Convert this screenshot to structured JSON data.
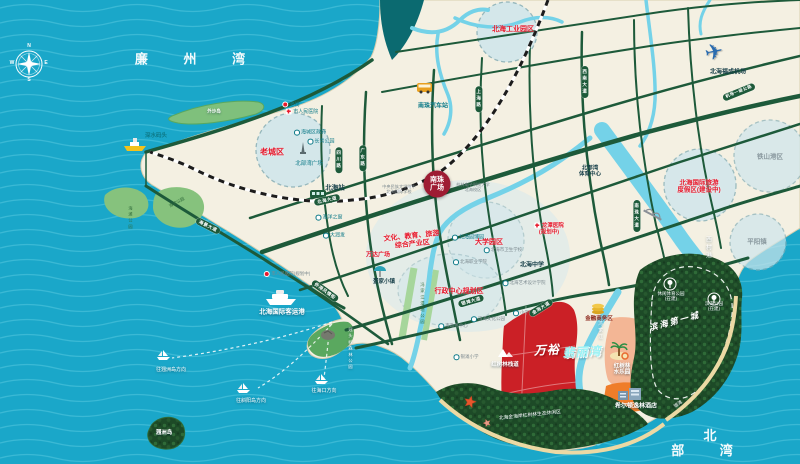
{
  "colors": {
    "ocean": "#1aa7c9",
    "wave": "#55c8de",
    "land": "#f4f0e2",
    "road": "#1d5a3a",
    "river": "#74d2e8",
    "deep_channel": "#0b6a70",
    "forest": "#1d4a27",
    "park": "#86c27d",
    "island": "#7fc07c",
    "zonefill": "#cfe6ec",
    "zonestroke": "#86aeb6",
    "red_zone": "#cb2026",
    "peach": "#f3b695",
    "orange": "#ef7d2a",
    "sand": "#ecd9a4",
    "badge": "#9e1c33",
    "accent_red": "#e8192c",
    "teal_text": "#0d7a88",
    "project_cyan": "#9df3f5",
    "railway": "#1c1c1c"
  },
  "labels": [
    {
      "name": "sea-label-lianzhou-bay",
      "text": "廉 州 湾",
      "x": 190,
      "y": 60,
      "cls": "seabig",
      "fs": 13
    },
    {
      "name": "sea-label-beibu-gulf",
      "text": "北 部 湾",
      "x": 710,
      "y": 444,
      "cls": "seabig",
      "fs": 13
    },
    {
      "name": "compass-letter-n",
      "text": "N",
      "x": 29,
      "y": 47,
      "cls": "comp",
      "fs": 5
    },
    {
      "name": "compass-letter-e",
      "text": "E",
      "x": 46,
      "y": 64,
      "cls": "comp",
      "fs": 5
    },
    {
      "name": "compass-letter-s",
      "text": "S",
      "x": 29,
      "y": 81,
      "cls": "comp",
      "fs": 5
    },
    {
      "name": "compass-letter-w",
      "text": "W",
      "x": 12,
      "y": 64,
      "cls": "comp",
      "fs": 5
    },
    {
      "name": "zone-label-industrial-park",
      "text": "北海工业园区",
      "x": 513,
      "y": 30,
      "cls": "red",
      "fs": 7
    },
    {
      "name": "zone-label-old-town",
      "text": "老城区",
      "x": 272,
      "y": 152,
      "cls": "red",
      "fs": 8
    },
    {
      "name": "zone-label-university-area",
      "text": "大学园区",
      "x": 489,
      "y": 243,
      "cls": "red",
      "fs": 7
    },
    {
      "name": "zone-label-admin-center",
      "text": "行政中心规划区",
      "x": 459,
      "y": 292,
      "cls": "red",
      "fs": 7
    },
    {
      "name": "zone-label-intl-tourism-resort",
      "text": "北海国际旅游\n度假区(建设中)",
      "x": 699,
      "y": 187,
      "cls": "red",
      "fs": 6.5
    },
    {
      "name": "zone-label-culture-industry",
      "text": "文化、教育、旅游\n综合产业区",
      "x": 412,
      "y": 241,
      "cls": "red",
      "fs": 7,
      "rot": -6
    },
    {
      "name": "zone-label-tieshangang",
      "text": "铁山港区",
      "x": 770,
      "y": 157,
      "cls": "grayz",
      "fs": 6.5
    },
    {
      "name": "zone-label-pingyang",
      "text": "平阳镇",
      "x": 757,
      "y": 242,
      "cls": "grayz",
      "fs": 6.5
    },
    {
      "name": "label-shenshui-wharf",
      "text": "深水码头",
      "x": 156,
      "y": 136,
      "cls": "tealb",
      "fs": 5.5
    },
    {
      "name": "label-waishadao-island",
      "text": "外沙岛",
      "x": 214,
      "y": 111,
      "cls": "whiteb",
      "fs": 4.5
    },
    {
      "name": "label-laojie-old-street",
      "text": "老街",
      "x": 291,
      "y": 105,
      "cls": "teal",
      "fs": 5,
      "m": "red"
    },
    {
      "name": "label-city-people-hospital",
      "text": "市人民医院",
      "x": 302,
      "y": 112,
      "cls": "teal",
      "fs": 5,
      "m": "cross"
    },
    {
      "name": "label-haicheng-district-gov",
      "text": "海城区政府",
      "x": 310,
      "y": 133,
      "cls": "teal",
      "fs": 5,
      "m": "dot"
    },
    {
      "name": "label-changqing-park",
      "text": "长青公园",
      "x": 321,
      "y": 142,
      "cls": "teal",
      "fs": 5,
      "m": "dot"
    },
    {
      "name": "label-beibuwan-square",
      "text": "北部湾广场",
      "x": 309,
      "y": 164,
      "cls": "teal",
      "fs": 5.5
    },
    {
      "name": "label-nanzhu-bus-station",
      "text": "南珠汽车站",
      "x": 433,
      "y": 107,
      "cls": "tealb",
      "fs": 6
    },
    {
      "name": "label-fucheng-airport",
      "text": "北海福成机场",
      "x": 728,
      "y": 73,
      "cls": "dark",
      "fs": 6
    },
    {
      "name": "airplane-icon",
      "text": "✈",
      "x": 714,
      "y": 52,
      "cls": "plane",
      "fs": 22,
      "rot": -12
    },
    {
      "name": "label-beihai-railway-station",
      "text": "北海站",
      "x": 335,
      "y": 188,
      "cls": "dark",
      "fs": 6.5
    },
    {
      "name": "label-ocean-window",
      "text": "海洋之窗",
      "x": 329,
      "y": 218,
      "cls": "teal",
      "fs": 5,
      "m": "dot"
    },
    {
      "name": "label-rt-mart",
      "text": "大润发",
      "x": 334,
      "y": 236,
      "cls": "teal",
      "fs": 5,
      "m": "dot"
    },
    {
      "name": "label-people-hospital-planned",
      "text": "市人民医院(规划中)",
      "x": 287,
      "y": 274,
      "cls": "gray",
      "fs": 4.5,
      "m": "red"
    },
    {
      "name": "label-wanda-plaza",
      "text": "万达广场",
      "x": 378,
      "y": 256,
      "cls": "red",
      "fs": 6
    },
    {
      "name": "label-danjia-town",
      "text": "疍家小镇",
      "x": 384,
      "y": 282,
      "cls": "dark",
      "fs": 5.5
    },
    {
      "name": "label-yuanbo-garden",
      "text": "北海园博园",
      "x": 468,
      "y": 238,
      "cls": "teal",
      "fs": 5,
      "m": "dot"
    },
    {
      "name": "label-health-school",
      "text": "北海市卫生学校",
      "x": 503,
      "y": 250,
      "cls": "gray",
      "fs": 4.5,
      "m": "dot"
    },
    {
      "name": "label-vocational-college",
      "text": "北海职业学院",
      "x": 470,
      "y": 262,
      "cls": "gray",
      "fs": 4.5,
      "m": "dot"
    },
    {
      "name": "label-beihai-middle-school",
      "text": "北海中学",
      "x": 532,
      "y": 266,
      "cls": "dark",
      "fs": 6
    },
    {
      "name": "label-art-design-college",
      "text": "北海艺术设计学院",
      "x": 524,
      "y": 283,
      "cls": "gray",
      "fs": 4.5,
      "m": "dot"
    },
    {
      "name": "label-gov-service-center",
      "text": "市政务中心",
      "x": 453,
      "y": 326,
      "cls": "gray",
      "fs": 4.5,
      "m": "dot"
    },
    {
      "name": "label-binhai-culture-park",
      "text": "滨海文化公园",
      "x": 488,
      "y": 319,
      "cls": "gray",
      "fs": 4.5,
      "m": "dot"
    },
    {
      "name": "label-longtan-hospital",
      "text": "龙潭医院\n(规划中)",
      "x": 549,
      "y": 229,
      "cls": "red",
      "fs": 5.5,
      "m": "cross"
    },
    {
      "name": "label-beibuwan-sports-center",
      "text": "北部湾\n体育中心",
      "x": 590,
      "y": 172,
      "cls": "dark",
      "fs": 5.5
    },
    {
      "name": "label-finance-business-district",
      "text": "金融商务区",
      "x": 599,
      "y": 319,
      "cls": "darkred",
      "fs": 5.5
    },
    {
      "name": "label-primary-school",
      "text": "小学",
      "x": 521,
      "y": 313,
      "cls": "gray",
      "fs": 4.5,
      "m": "dot"
    },
    {
      "name": "label-yintan-primary-school",
      "text": "银滩小学",
      "x": 466,
      "y": 357,
      "cls": "gray",
      "fs": 4.5,
      "m": "dot"
    },
    {
      "name": "label-mangrove-boardwalk",
      "text": "红树林栈道",
      "x": 505,
      "y": 365,
      "cls": "whiteb",
      "fs": 5.5
    },
    {
      "name": "project-name-prefix",
      "text": "万裕",
      "x": 547,
      "y": 351,
      "cls": "proj1",
      "fs": 12,
      "rot": -3
    },
    {
      "name": "project-name-suffix",
      "text": "翡丽湾",
      "x": 582,
      "y": 353,
      "cls": "proj2",
      "fs": 12,
      "rot": -3
    },
    {
      "name": "label-mangrove-water-park",
      "text": "红树林\n水乐园",
      "x": 622,
      "y": 370,
      "cls": "whiteb",
      "fs": 5.5
    },
    {
      "name": "label-hilton-doubletree-hotel",
      "text": "希尔顿逸林酒店",
      "x": 636,
      "y": 407,
      "cls": "whiteb",
      "fs": 6
    },
    {
      "name": "label-leisure-sports-park",
      "text": "休闲体育公园\n(在建)",
      "x": 671,
      "y": 296,
      "cls": "white",
      "fs": 4.5
    },
    {
      "name": "label-binhai-park",
      "text": "滨海公园\n(在建)",
      "x": 714,
      "y": 306,
      "cls": "white",
      "fs": 4.5
    },
    {
      "name": "label-binhai-first-city",
      "text": "滨海第一城",
      "x": 675,
      "y": 323,
      "cls": "script",
      "fs": 8.5,
      "rot": -15
    },
    {
      "name": "label-mangrove-eco-area",
      "text": "北海金海岸红树林生态休闲区",
      "x": 530,
      "y": 416,
      "cls": "white",
      "fs": 4.8,
      "rot": -6
    },
    {
      "name": "label-yintan-beach",
      "text": "银滩",
      "x": 678,
      "y": 404,
      "cls": "white",
      "fs": 4.5,
      "rot": -35
    },
    {
      "name": "label-intl-passenger-port",
      "text": "北海国际客运港",
      "x": 282,
      "y": 312,
      "cls": "whiteb",
      "fs": 6.5
    },
    {
      "name": "label-route-weizhou",
      "text": "往涠洲岛方向",
      "x": 171,
      "y": 371,
      "cls": "white",
      "fs": 5
    },
    {
      "name": "label-route-xieyang",
      "text": "往斜阳岛方向",
      "x": 251,
      "y": 402,
      "cls": "white",
      "fs": 5
    },
    {
      "name": "label-route-haikou",
      "text": "往海口方向",
      "x": 324,
      "y": 392,
      "cls": "white",
      "fs": 5
    },
    {
      "name": "label-weizhou-island",
      "text": "涠洲岛",
      "x": 164,
      "y": 433,
      "cls": "whiteb",
      "fs": 5.5
    },
    {
      "name": "label-guantouling-forest-park",
      "text": "冠头岭森林公园",
      "x": 350,
      "y": 349,
      "cls": "white vert",
      "fs": 4.2
    },
    {
      "name": "label-beach-park",
      "text": "海滩公园",
      "x": 130,
      "y": 218,
      "cls": "parkt vert",
      "fs": 4.2
    },
    {
      "name": "label-seaside-park",
      "text": "海滨公园",
      "x": 177,
      "y": 203,
      "cls": "parkt",
      "fs": 4.2,
      "rot": -28
    },
    {
      "name": "label-xicungang-river",
      "text": "西村港",
      "x": 707,
      "y": 248,
      "cls": "white vert",
      "fs": 6
    },
    {
      "name": "label-fengjiajiang-river",
      "text": "冯家江",
      "x": 601,
      "y": 331,
      "cls": "white vert",
      "fs": 4.5
    },
    {
      "name": "label-fengjiajiang-wetland",
      "text": "冯家江湿地公园",
      "x": 422,
      "y": 304,
      "cls": "parkt vert",
      "fs": 4.2
    },
    {
      "name": "label-minzu-school",
      "text": "中央民族大学附中\n北海国际学校",
      "x": 399,
      "y": 190,
      "cls": "gray",
      "fs": 4.2
    },
    {
      "name": "label-guilin-univ-campus",
      "text": "桂林电子科技大学\n北海校区",
      "x": 473,
      "y": 188,
      "cls": "gray",
      "fs": 4.2
    },
    {
      "name": "badge-nanzhu-plaza",
      "text": "南珠\n广场",
      "x": 437,
      "y": 184,
      "cls": "badge",
      "fs": 7
    },
    {
      "name": "roadcap-xinan-avenue",
      "text": "西南大道",
      "x": 585,
      "y": 82,
      "cls": "roadcap vert",
      "fs": 4.5
    },
    {
      "name": "roadcap-nanzhu-avenue",
      "text": "南珠大道",
      "x": 637,
      "y": 216,
      "cls": "roadcap vert",
      "fs": 4.5
    },
    {
      "name": "roadcap-sichuan-road",
      "text": "四川路",
      "x": 339,
      "y": 160,
      "cls": "roadcap vert",
      "fs": 4.5
    },
    {
      "name": "roadcap-guangdong-road",
      "text": "广东路",
      "x": 363,
      "y": 158,
      "cls": "roadcap vert",
      "fs": 4.5
    },
    {
      "name": "roadcap-shanghai-road",
      "text": "上海路",
      "x": 479,
      "y": 99,
      "cls": "roadcap vert",
      "fs": 4.5
    },
    {
      "name": "roadcap-beihai-avenue",
      "text": "北海大道",
      "x": 327,
      "y": 200,
      "cls": "roadcap",
      "fs": 4.5,
      "rot": -13
    },
    {
      "name": "roadcap-haijing-avenue",
      "text": "海景大道",
      "x": 208,
      "y": 226,
      "cls": "roadcap",
      "fs": 4.5,
      "rot": 27
    },
    {
      "name": "roadcap-yintan-avenue",
      "text": "银滩大道",
      "x": 471,
      "y": 301,
      "cls": "roadcap",
      "fs": 4.5,
      "rot": -16
    },
    {
      "name": "roadcap-jinhai-avenue",
      "text": "金海大道",
      "x": 541,
      "y": 308,
      "cls": "roadcap",
      "fs": 4.5,
      "rot": -32
    },
    {
      "name": "roadcap-qiaogang-street",
      "text": "侨港风情街",
      "x": 325,
      "y": 291,
      "cls": "roadcap",
      "fs": 4.5,
      "rot": 36
    },
    {
      "name": "roadcap-airport-highway",
      "text": "机场一级公路",
      "x": 739,
      "y": 92,
      "cls": "roadcap",
      "fs": 4.2,
      "rot": -22
    }
  ]
}
